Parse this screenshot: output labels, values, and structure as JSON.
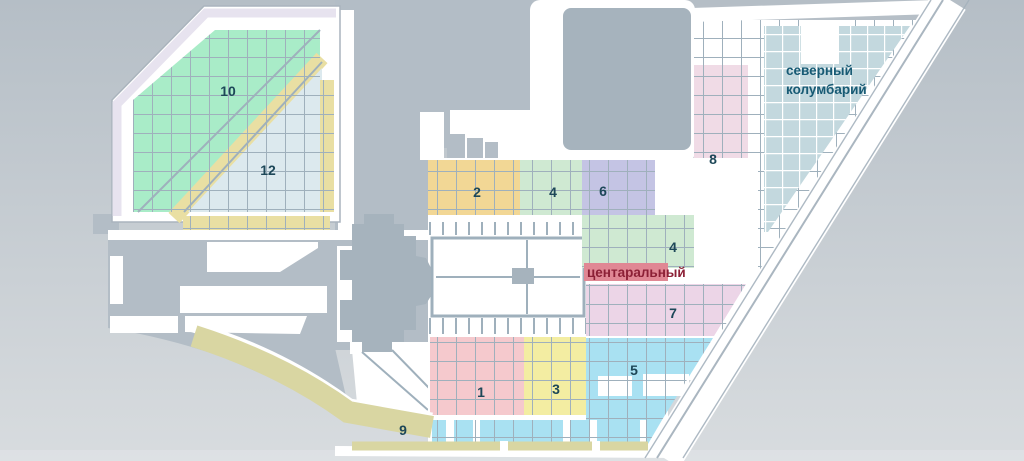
{
  "map": {
    "background": {
      "top": "#b5bec6",
      "bottom": "#d8dcdf"
    },
    "palette": {
      "ground": "#b3bdc6",
      "building": "#a6b3bd",
      "road": "#ffffff",
      "grid_line": "#9fb0bc",
      "border_band": "#e7e3ef",
      "path_yellow": "#e9dfa3",
      "label_color": "#1d4758"
    },
    "sections": {
      "s1": {
        "label": "1",
        "color": "#f5c9cd"
      },
      "s2": {
        "label": "2",
        "color": "#f2d795"
      },
      "s3": {
        "label": "3",
        "color": "#f3eda2"
      },
      "s4": {
        "label": "4",
        "color": "#cfe9d2"
      },
      "s4b": {
        "label": "4",
        "color": "#cfe9d2"
      },
      "s5": {
        "label": "5",
        "color": "#a9e1f2"
      },
      "s6": {
        "label": "6",
        "color": "#c4c4e4"
      },
      "s7": {
        "label": "7",
        "color": "#ecd5e7"
      },
      "s8": {
        "label": "8",
        "color": "#f0dbe6"
      },
      "s9": {
        "label": "9",
        "color": "#d9d6a2"
      },
      "s10": {
        "label": "10",
        "color": "#a9ecc8"
      },
      "s12": {
        "label": "12",
        "color": "#dce9ee"
      },
      "stair": {
        "color": "#efeac4"
      }
    },
    "north_columbarium": {
      "line1": "северный",
      "line2": "колумбарий",
      "color": "#c3d8de",
      "text_color": "#175a74"
    },
    "central_alley": {
      "label": "центаральный",
      "text_color": "#8c2036",
      "highlight": "#e08794"
    }
  }
}
